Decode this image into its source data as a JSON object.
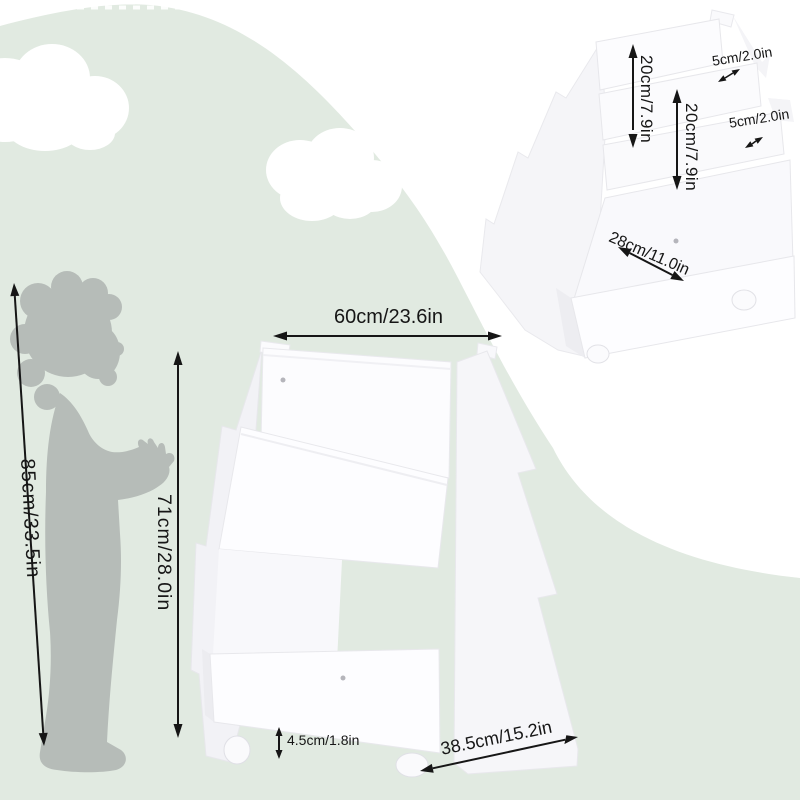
{
  "diagram": {
    "front_view": {
      "width": "60cm/23.6in",
      "height": "71cm/28.0in",
      "caster_height": "4.5cm/1.8in",
      "base_depth": "38.5cm/15.2in"
    },
    "child": {
      "height": "85cm/33.5in"
    },
    "rear_view": {
      "top_shelf_height": "20cm/7.9in",
      "middle_shelf_height": "20cm/7.9in",
      "top_shelf_lip": "5cm/2.0in",
      "middle_shelf_lip": "5cm/2.0in",
      "bin_depth": "28cm/11.0in"
    },
    "colors": {
      "background_green": "#e1eae1",
      "cloud_white": "#ffffff",
      "silhouette_gray": "#b6bcb8",
      "furniture_white": "#fcfcfe",
      "dimension_black": "#161616"
    }
  }
}
